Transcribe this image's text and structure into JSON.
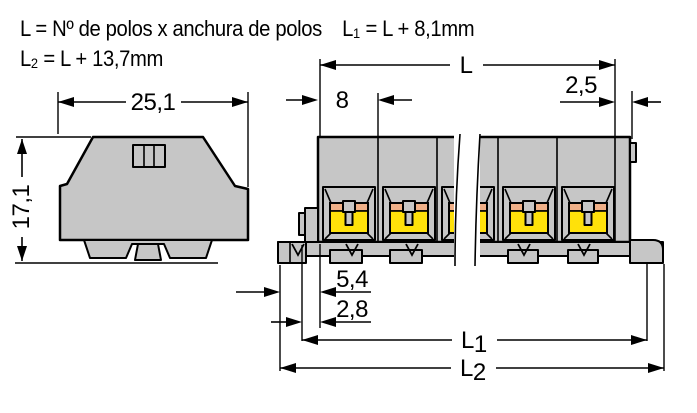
{
  "header": {
    "formula_total_length": "L = Nº de polos x anchura de polos",
    "formula_l1": {
      "base": "L",
      "sub": "1",
      "rest": " = L + 8,1mm"
    },
    "formula_l2": {
      "base": "L",
      "sub": "2",
      "rest": " = L + 13,7mm"
    }
  },
  "front_view": {
    "width_label": "25,1",
    "height_label": "17,1"
  },
  "side_view": {
    "pole_pitch_label": "8",
    "end_plate_label": "2,5",
    "total_length_label": "L",
    "length_l1": {
      "base": "L",
      "sub": "1"
    },
    "length_l2": {
      "base": "L",
      "sub": "2"
    },
    "rail_foot_offset_label": "5,4",
    "rail_notch_offset_label": "2,8"
  },
  "colors": {
    "background": "#ffffff",
    "body_gray": "#c6c6c6",
    "contact_yellow": "#ffe10a",
    "clamp_salmon": "#f0b088",
    "line_black": "#000000"
  }
}
